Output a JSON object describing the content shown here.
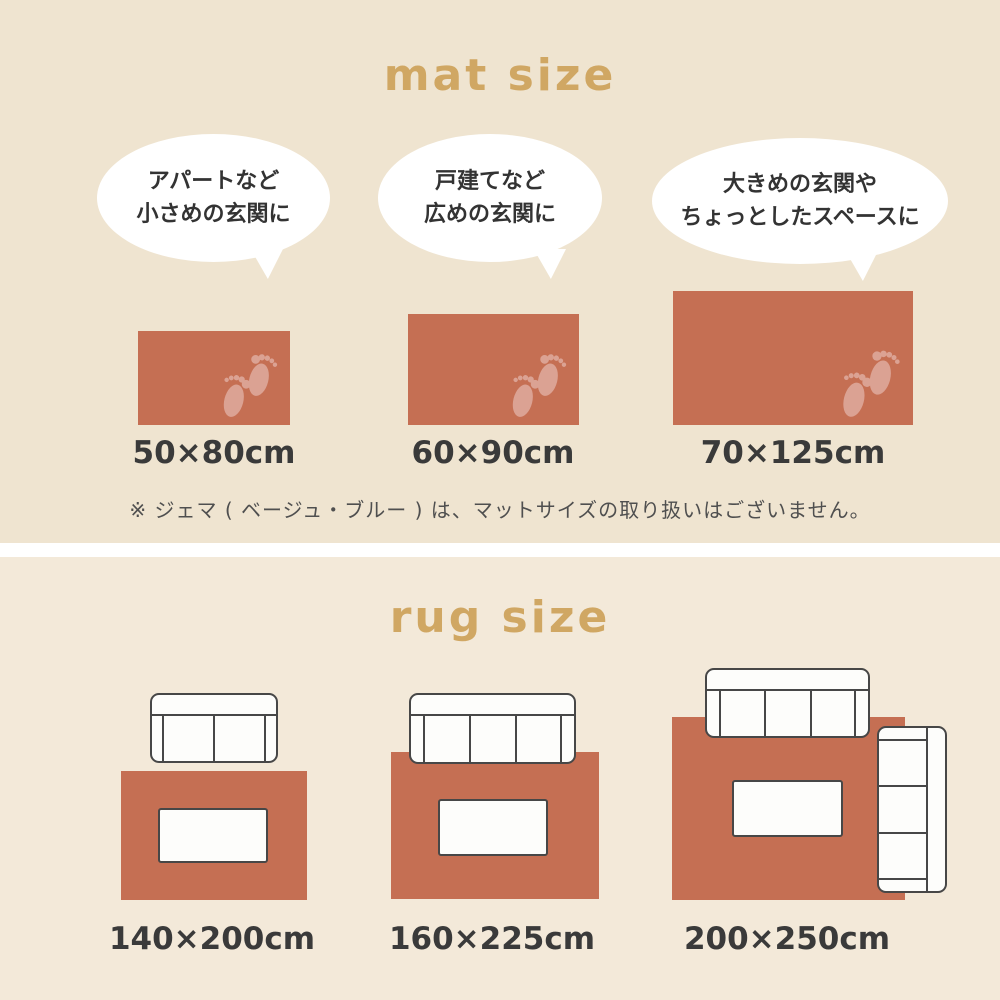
{
  "colors": {
    "mat_section_background": "#efe4d0",
    "rug_section_background": "#f3e9d9",
    "divider": "#ffffff",
    "title_gold": "#d0a763",
    "mat_rug_terracotta": "#c56f53",
    "footprint_pink": "#dba293",
    "label_text": "#3a3a3a",
    "note_text": "#4f4f4f",
    "bubble_fill": "#ffffff",
    "furniture_outline": "#474747"
  },
  "mat_section": {
    "title": "mat size",
    "items": [
      {
        "bubble": [
          "アパートなど",
          "小さめの玄関に"
        ],
        "size": "50×80cm",
        "icon": "footprints-icon"
      },
      {
        "bubble": [
          "戸建てなど",
          "広めの玄関に"
        ],
        "size": "60×90cm",
        "icon": "footprints-icon"
      },
      {
        "bubble": [
          "大きめの玄関や",
          "ちょっとしたスペースに"
        ],
        "size": "70×125cm",
        "icon": "footprints-icon"
      }
    ],
    "note": "※ ジェマ ( ベージュ・ブルー ) は、マットサイズの取り扱いはございません。"
  },
  "rug_section": {
    "title": "rug size",
    "items": [
      {
        "size": "140×200cm",
        "furniture": [
          "2-seat sofa (top)",
          "low table (center)"
        ]
      },
      {
        "size": "160×225cm",
        "furniture": [
          "3-seat sofa (top, overlapping rug)",
          "low table (center)"
        ]
      },
      {
        "size": "200×250cm",
        "furniture": [
          "3-seat sofa (top, overlapping rug)",
          "3-seat sofa (right side, overlapping rug)",
          "low table (center)"
        ]
      }
    ]
  }
}
